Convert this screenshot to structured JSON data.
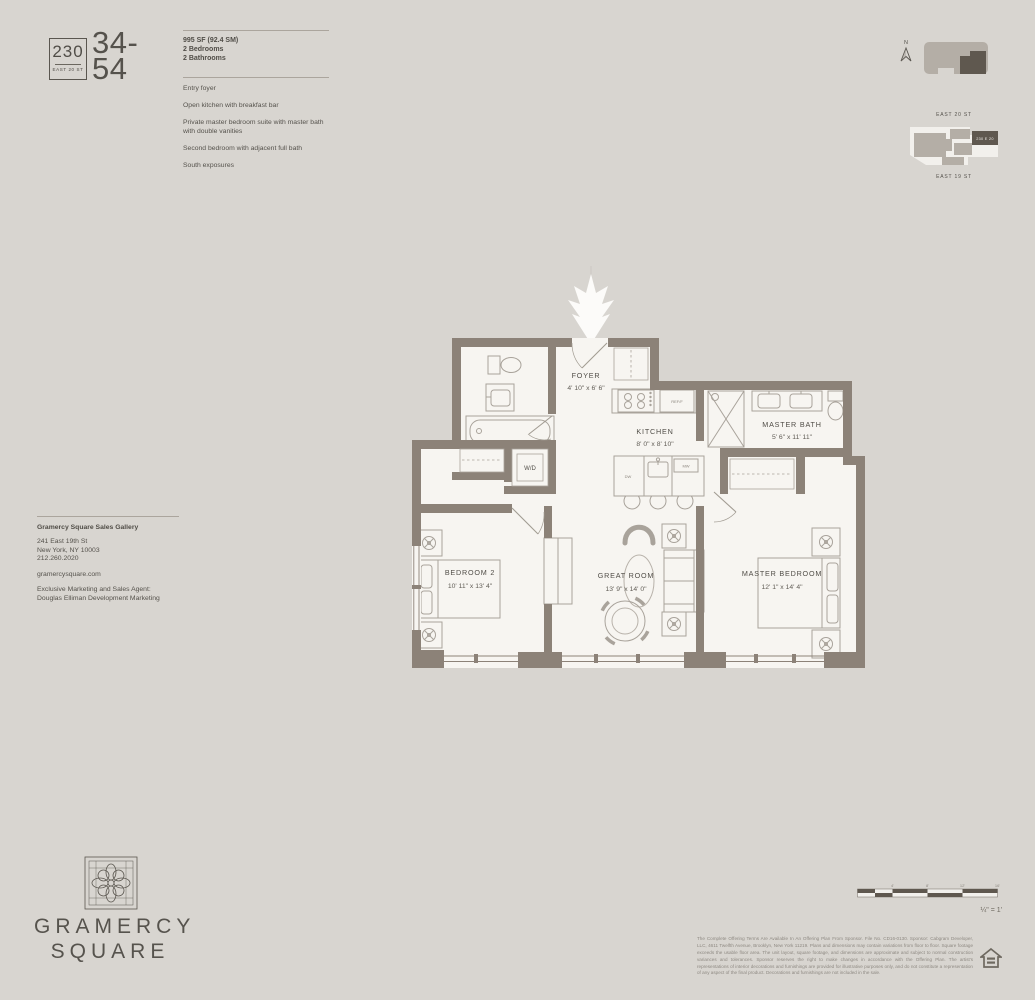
{
  "unit": {
    "building_number": "230",
    "building_street": "EAST 20 ST",
    "floor_range_line1": "34-",
    "floor_range_line2": "54",
    "area": "995 SF (92.4 SM)",
    "bedrooms": "2 Bedrooms",
    "bathrooms": "2 Bathrooms",
    "features": [
      "Entry foyer",
      "Open kitchen with breakfast bar",
      "Private master bedroom suite with master bath with double vanities",
      "Second bedroom with adjacent full bath",
      "South exposures"
    ]
  },
  "site": {
    "north_label": "N",
    "street_top": "EAST 20 ST",
    "street_bottom": "EAST 19 ST",
    "unit_map_label": "230 E 20"
  },
  "plan": {
    "foyer_name": "FOYER",
    "foyer_dims": "4' 10\" x 6' 6\"",
    "kitchen_name": "KITCHEN",
    "kitchen_dims": "8' 0\" x 8' 10\"",
    "master_bath_name": "MASTER BATH",
    "master_bath_dims": "5' 6\" x 11' 11\"",
    "bedroom2_name": "BEDROOM 2",
    "bedroom2_dims": "10' 11\" x 13' 4\"",
    "great_room_name": "GREAT ROOM",
    "great_room_dims": "13' 9\" x 14' 0\"",
    "master_bedroom_name": "MASTER BEDROOM",
    "master_bedroom_dims": "12' 1\" x 14' 4\"",
    "washer_dryer": "W/D",
    "fridge": "REF/F",
    "dishwasher": "DW",
    "microwave": "MW"
  },
  "contact": {
    "gallery_title": "Gramercy Square Sales Gallery",
    "address_line1": "241 East 19th St",
    "address_line2": "New York, NY 10003",
    "phone": "212.260.2020",
    "website": "gramercysquare.com",
    "agent_line1": "Exclusive Marketing and Sales Agent:",
    "agent_line2": "Douglas Elliman Development Marketing"
  },
  "logo": {
    "line1": "GRAMERCY",
    "line2": "SQUARE"
  },
  "scalebar": {
    "ticks": [
      "4'",
      "8'",
      "12'",
      "16'"
    ],
    "ratio": "¼\" = 1'"
  },
  "legal": {
    "text": "The Complete Offering Terms Are Available In An Offering Plan From Sponsor. File No. CD16-0130. Sponsor: Cabgram Developer, LLC, 4611 Twelfth Avenue, Brooklyn, New York 11219. Plans and dimensions may contain variations from floor to floor. Square footage exceeds the usable floor area. The unit layout, square footage, and dimensions are approximate and subject to normal construction variances and tolerances. Sponsor reserves the right to make changes in accordance with the Offering Plan. The artist's representations of interior decorations and furnishings are provided for illustrative purposes only, and do not constitute a representation of any aspect of the final product. Decorations and furnishings are not included in the sale."
  }
}
